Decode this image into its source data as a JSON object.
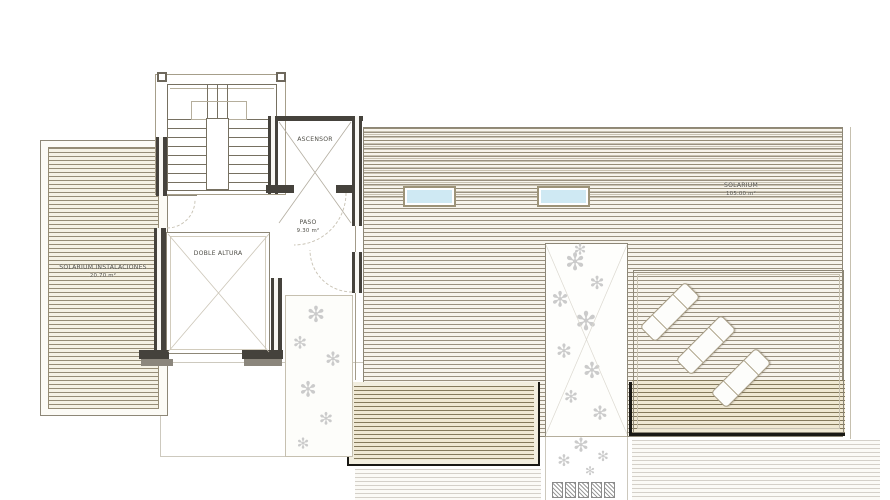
{
  "rooms": {
    "ascensor": {
      "label": "ASCENSOR"
    },
    "paso": {
      "label": "PASO",
      "area": "9.30 m²"
    },
    "doble_altura": {
      "label": "DOBLE ALTURA"
    },
    "solarium_instalaciones": {
      "label": "SOLARIUM INSTALACIONES",
      "area": "20.70 m²"
    },
    "solarium": {
      "label": "SOLARIUM",
      "area": "105.00 m²"
    }
  },
  "fixtures": {
    "skylights": 2,
    "sun_loungers": 3,
    "stepping_stones": 5,
    "planters": 3,
    "staircase": 1,
    "elevator": 1
  },
  "icons": {
    "plant": "✻"
  },
  "colors": {
    "wall_dark": "#45423c",
    "deck_line": "#9a9180",
    "deck_bg": "#f7f4ec",
    "deck_dark_line": "#857a5c",
    "skylight_fill": "#cfe9f3",
    "outline_black": "#191814",
    "plant": "#cbcbcb"
  }
}
